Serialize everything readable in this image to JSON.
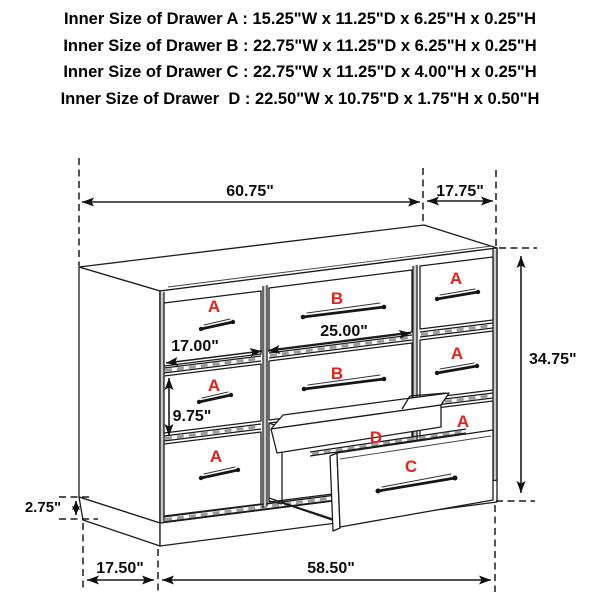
{
  "header": {
    "lines": [
      "Inner Size of Drawer A : 15.25\"W x 11.25\"D x 6.25\"H x 0.25\"H",
      "Inner Size of Drawer B : 22.75\"W x 11.25\"D x 6.25\"H x 0.25\"H",
      "Inner Size of Drawer C : 22.75\"W x 11.25\"D x 4.00\"H x 0.25\"H",
      "Inner Size of Drawer  D : 22.50\"W x 10.75\"D x 1.75\"H x 0.50\"H"
    ]
  },
  "dimensions": {
    "top_width": "60.75\"",
    "top_depth": "17.75\"",
    "overall_height": "34.75\"",
    "drawer_b_width": "25.00\"",
    "drawer_a_width": "17.00\"",
    "drawer_a_height": "9.75\"",
    "base_height": "2.75\"",
    "base_side_depth": "17.50\"",
    "base_front_width": "58.50\""
  },
  "drawer_letters": {
    "a": "A",
    "b": "B",
    "c": "C",
    "d": "D"
  },
  "colors": {
    "label_red": "#e8211d",
    "line": "#1c1c1c",
    "gap_gray": "#9a9a9a",
    "dim_text": "#0d0d0d"
  }
}
